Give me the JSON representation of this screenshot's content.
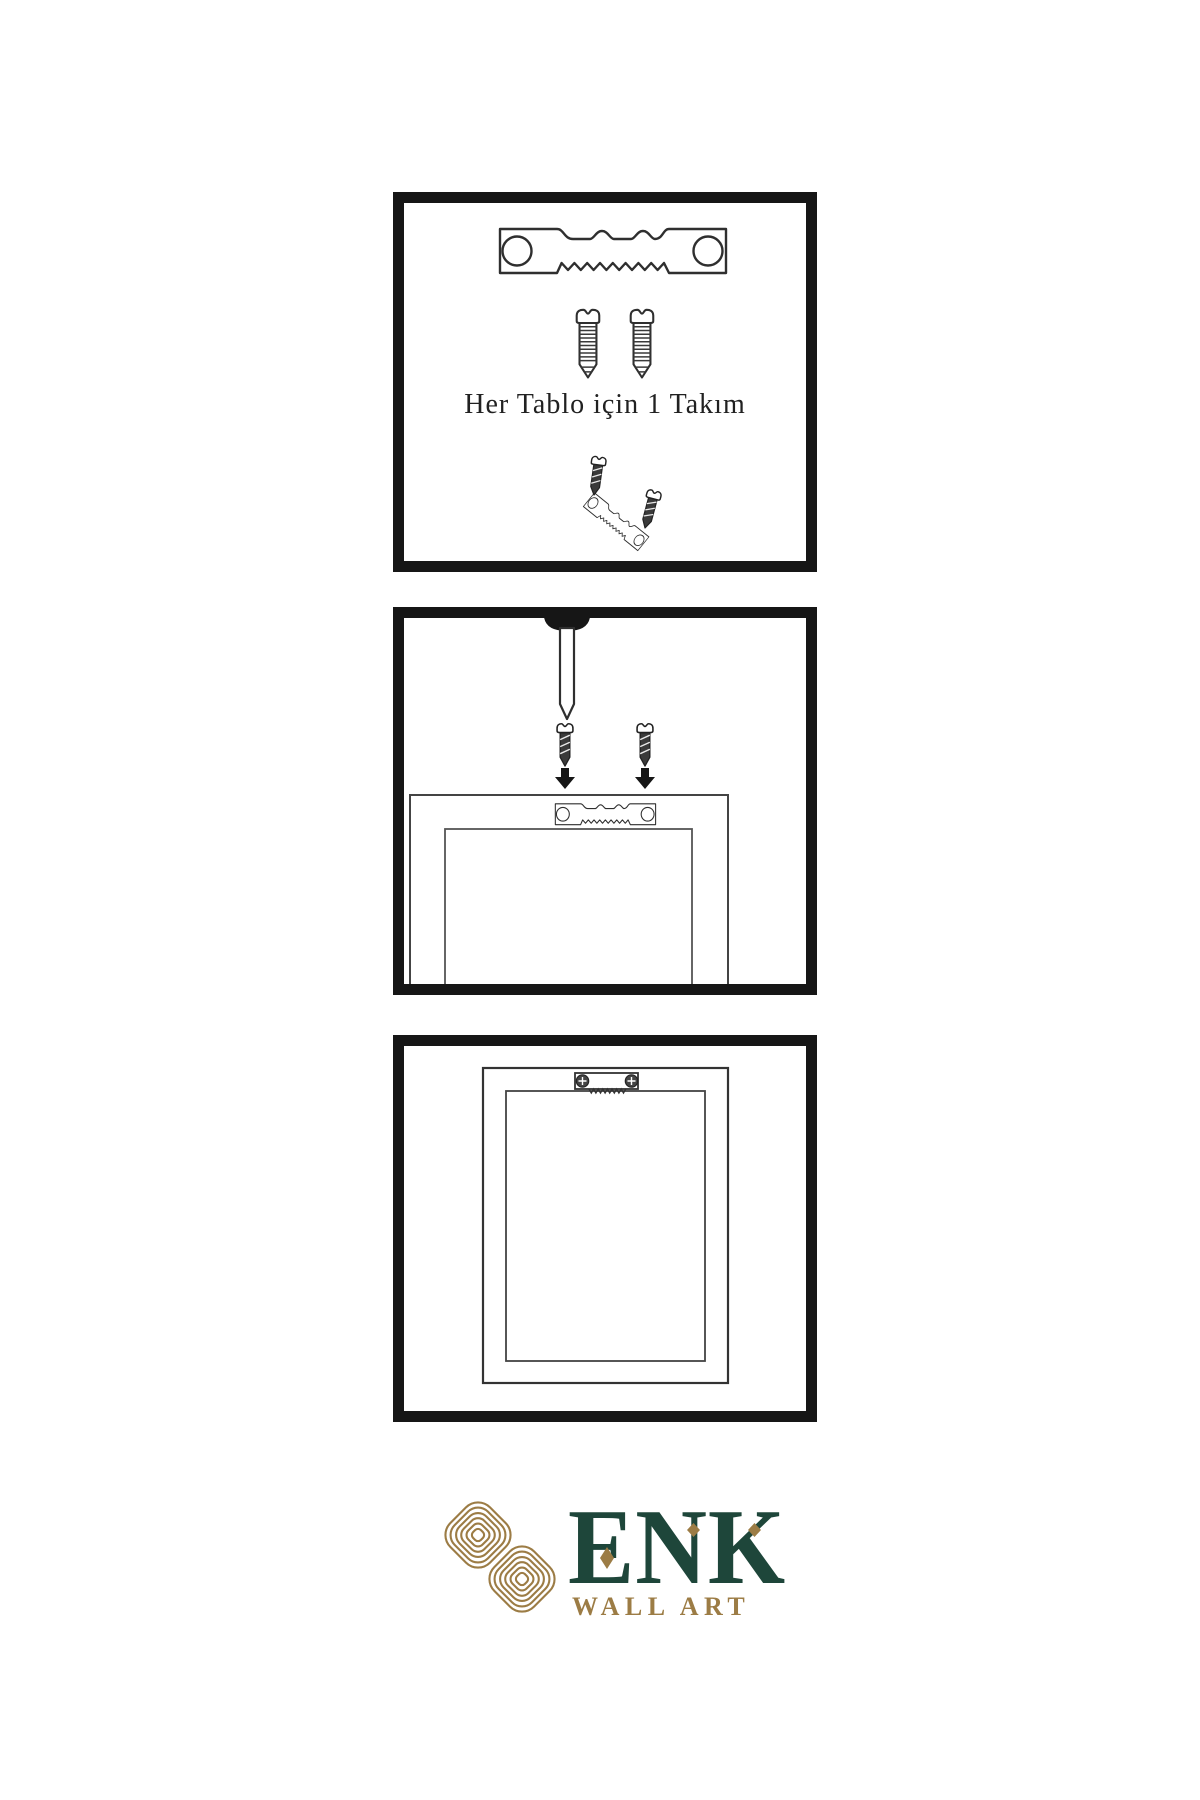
{
  "colors": {
    "background": "#ffffff",
    "panel_border": "#161616",
    "line_art": "#2f2f2f",
    "dark_metal": "#3a3a3a",
    "logo_gold": "#9c7c45",
    "logo_green": "#1e463a",
    "caption_text": "#212121"
  },
  "step1": {
    "caption": "Her Tablo için 1 Takım",
    "icons": [
      "sawtooth-hanger-icon",
      "threaded-screw-icon",
      "threaded-screw-icon",
      "screw-driving-into-hanger-icon"
    ]
  },
  "step2": {
    "icons": [
      "wall-nail-icon",
      "dark-screw-icon",
      "dark-screw-icon",
      "down-arrow-icon",
      "down-arrow-icon",
      "frame-back-icon",
      "sawtooth-hanger-icon"
    ]
  },
  "step3": {
    "icons": [
      "frame-back-icon",
      "mounted-sawtooth-hanger-icon"
    ]
  },
  "logo": {
    "brand": "ENK",
    "subtitle": "WALL ART",
    "mark": "knot-logo-icon"
  }
}
